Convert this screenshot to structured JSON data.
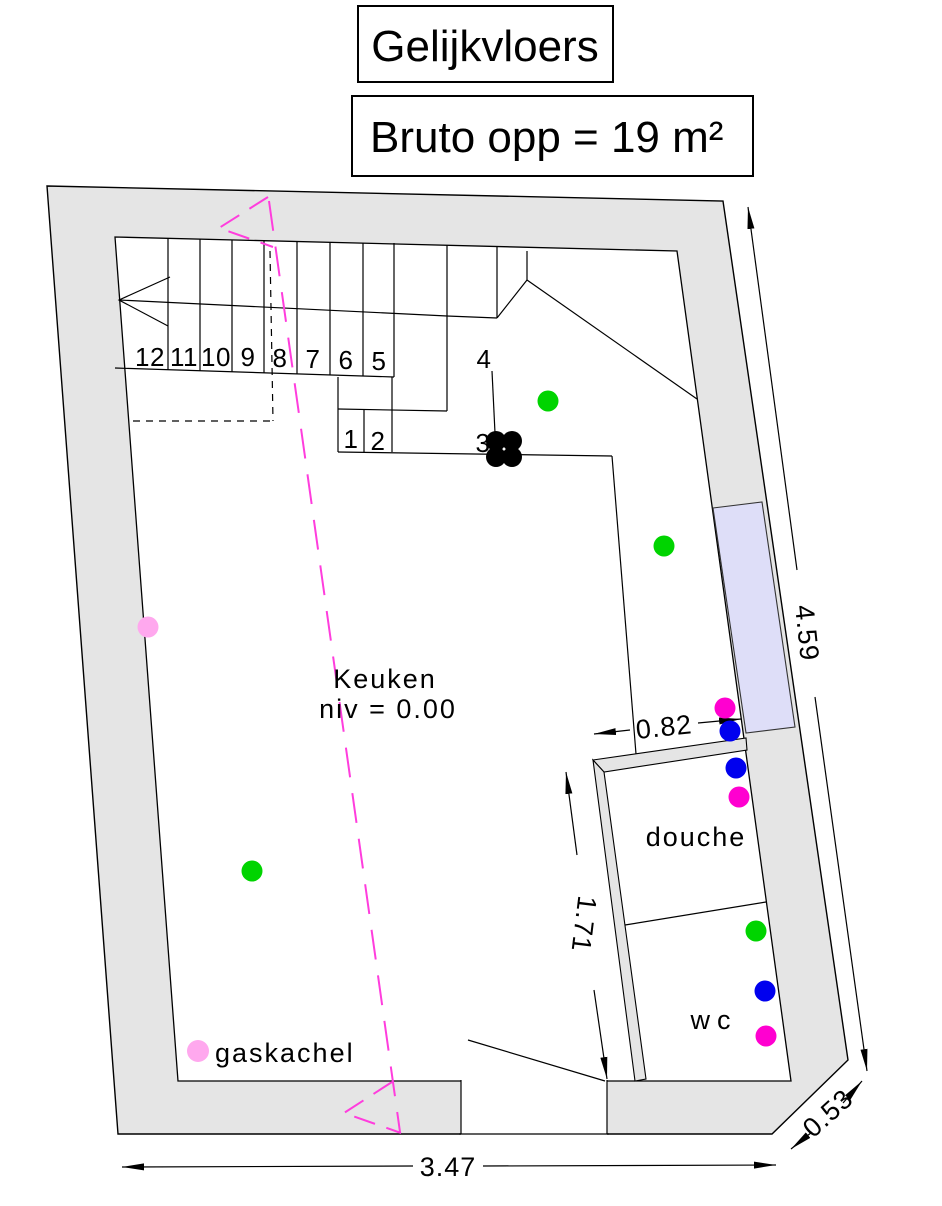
{
  "title": "Gelijkvloers",
  "subtitle": "Bruto opp = 19 m²",
  "rooms": {
    "keuken": {
      "name": "Keuken",
      "level": "niv = 0.00"
    },
    "douche": {
      "name": "douche"
    },
    "wc": {
      "name": "wc"
    }
  },
  "equipment": {
    "gaskachel": "gaskachel"
  },
  "stairs": {
    "numbers": [
      "12",
      "11",
      "10",
      "9",
      "8",
      "7",
      "6",
      "5",
      "4",
      "3",
      "2",
      "1"
    ]
  },
  "dimensions": {
    "right_height": "4.59",
    "douche_width": "0.82",
    "hall_depth": "1.71",
    "bottom_width": "3.47",
    "chamfer": "0.53"
  },
  "colors": {
    "wall_fill": "#e5e5e5",
    "window_fill": "#dedef8",
    "section_line": "#ff3ddd",
    "dot_green": "#00d400",
    "dot_blue": "#0000ee",
    "dot_magenta": "#ff00d0",
    "dot_pink": "#ffa8ee",
    "dot_black": "#000000"
  }
}
